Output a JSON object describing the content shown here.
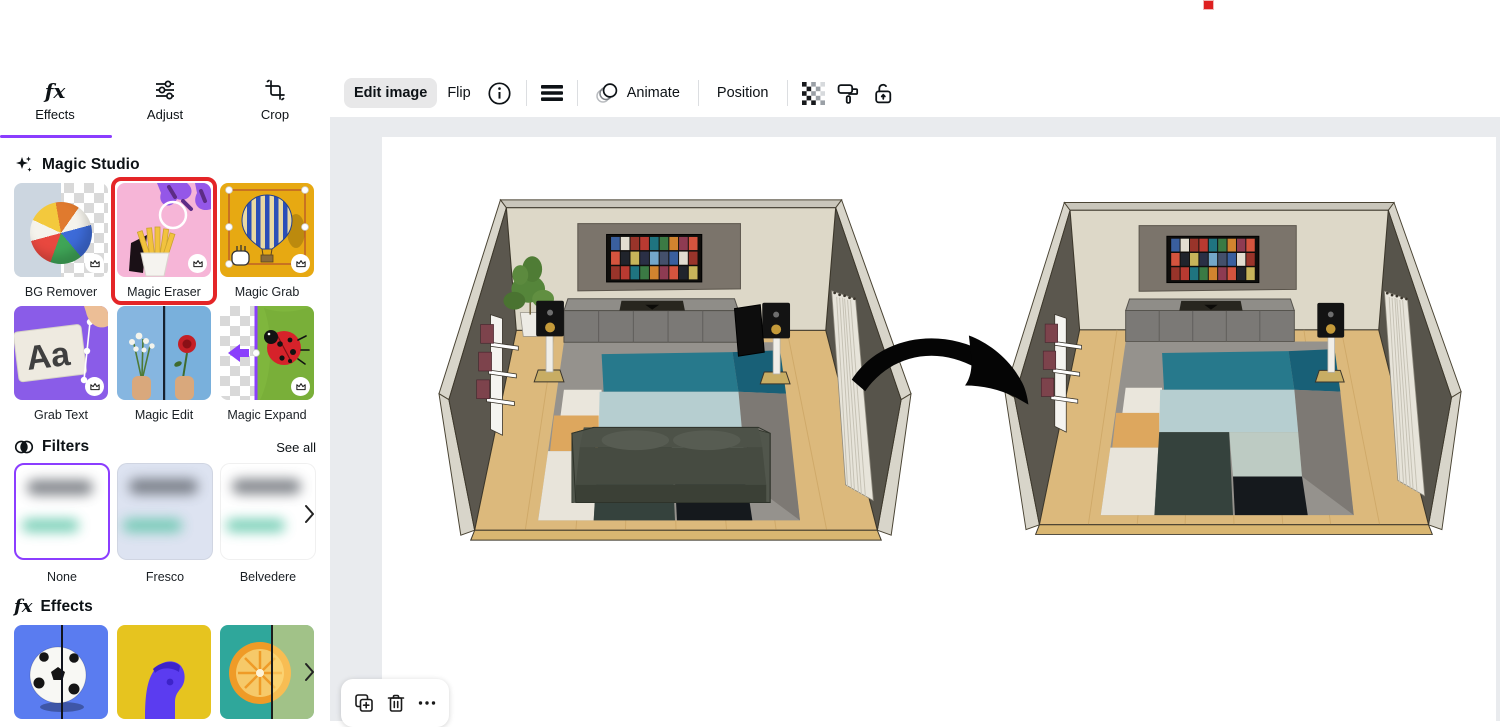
{
  "app": {
    "accent_color": "#8b3dff",
    "selection_red": "#e42527"
  },
  "toolbar": {
    "edit_image": "Edit image",
    "flip": "Flip",
    "animate": "Animate",
    "position": "Position"
  },
  "sidebar": {
    "tabs": [
      {
        "label": "Effects",
        "active": true
      },
      {
        "label": "Adjust",
        "active": false
      },
      {
        "label": "Crop",
        "active": false
      }
    ],
    "magic_studio": {
      "title": "Magic Studio",
      "items": [
        {
          "label": "BG Remover",
          "premium": true
        },
        {
          "label": "Magic Eraser",
          "premium": true,
          "selected": true
        },
        {
          "label": "Magic Grab",
          "premium": true
        },
        {
          "label": "Grab Text",
          "premium": true,
          "sample_text": "Aa"
        },
        {
          "label": "Magic Edit",
          "premium": false
        },
        {
          "label": "Magic Expand",
          "premium": true
        }
      ]
    },
    "filters": {
      "title": "Filters",
      "see_all": "See all",
      "items": [
        {
          "label": "None",
          "selected": true
        },
        {
          "label": "Fresco",
          "selected": false
        },
        {
          "label": "Belvedere",
          "selected": false
        }
      ]
    },
    "effects_section": {
      "title": "Effects"
    }
  },
  "canvas": {
    "scene": "3d living room render, before and after Magic Eraser (sofa, plant and left speakers removed)"
  }
}
